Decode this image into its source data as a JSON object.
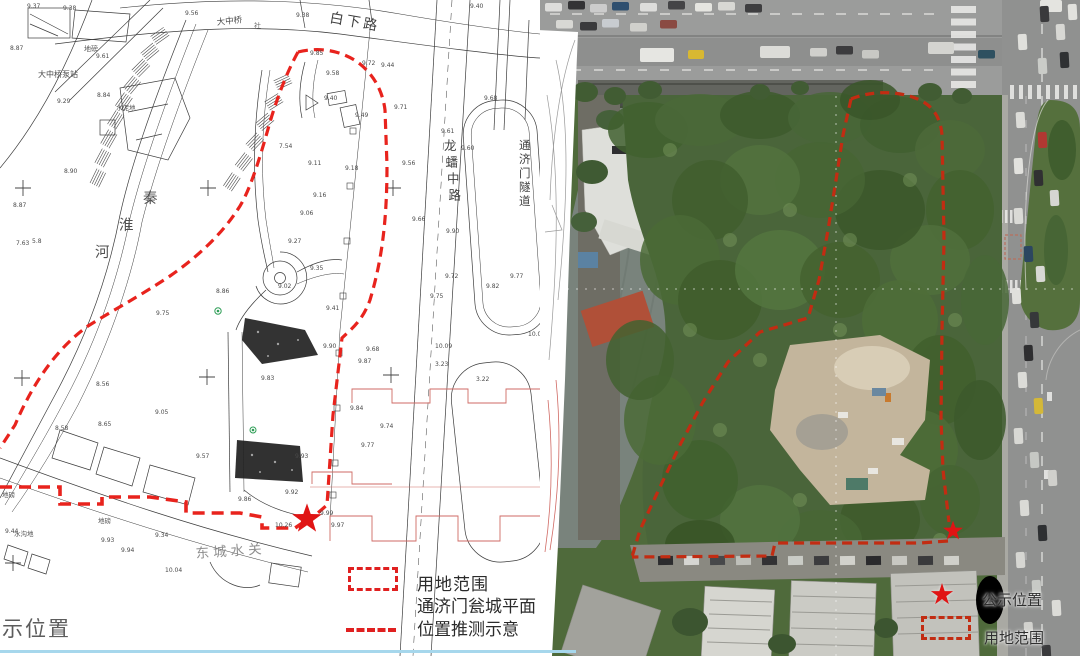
{
  "left_map": {
    "labels": [
      {
        "t": "白下路",
        "x": 329,
        "y": 22,
        "s": 14,
        "r": 10,
        "ls": 3,
        "c": "#3f3f3f"
      },
      {
        "t": "大中桥",
        "x": 217,
        "y": 25,
        "s": 8.5,
        "r": -6,
        "c": "#4a4a4a"
      },
      {
        "t": "社",
        "x": 254,
        "y": 28,
        "s": 7,
        "c": "#6a6a6a"
      },
      {
        "t": "地磅",
        "x": 84,
        "y": 51,
        "s": 7,
        "c": "#555555"
      },
      {
        "t": "大中桥泵站",
        "x": 38,
        "y": 77,
        "s": 8,
        "c": "#4a4a4a"
      },
      {
        "t": "水泥地",
        "x": 116,
        "y": 110,
        "s": 6.5,
        "c": "#555555"
      },
      {
        "t": "秦淮河",
        "x": 143,
        "y": 203,
        "s": 14.5,
        "c": "#4f4f4f",
        "v": {
          "dx": -24,
          "dy": 27
        }
      },
      {
        "t": "龙蟠中路",
        "x": 444,
        "y": 150,
        "s": 12.5,
        "c": "#3f3f3f",
        "v": {
          "dx": 1.5,
          "dy": 16.5
        }
      },
      {
        "t": "通济门隧道",
        "x": 519,
        "y": 149,
        "s": 11.5,
        "c": "#3f3f3f",
        "v": {
          "dx": 0,
          "dy": 14
        }
      },
      {
        "t": "东城水关",
        "x": 196,
        "y": 558,
        "s": 13.5,
        "r": -4,
        "ls": 4,
        "c": "#8f8f8f"
      },
      {
        "t": "地磅",
        "x": 98,
        "y": 523,
        "s": 6.5,
        "c": "#555555"
      },
      {
        "t": "地磅",
        "x": 2,
        "y": 497,
        "s": 6.5,
        "c": "#555555"
      },
      {
        "t": "水沟地",
        "x": 14,
        "y": 536,
        "s": 6.5,
        "c": "#555555"
      }
    ],
    "elevations": [
      [
        27,
        3,
        "9.37"
      ],
      [
        63,
        5,
        "9.38"
      ],
      [
        185,
        10,
        "9.56"
      ],
      [
        296,
        12,
        "9.38"
      ],
      [
        470,
        3,
        "9.40"
      ],
      [
        96,
        53,
        "9.61"
      ],
      [
        10,
        45,
        "8.87"
      ],
      [
        57,
        98,
        "9.29"
      ],
      [
        97,
        92,
        "8.84"
      ],
      [
        13,
        202,
        "8.87"
      ],
      [
        64,
        168,
        "8.90"
      ],
      [
        16,
        240,
        "7.63"
      ],
      [
        32,
        238,
        "5.8"
      ],
      [
        310,
        50,
        "9.85"
      ],
      [
        362,
        60,
        "9.72"
      ],
      [
        381,
        62,
        "9.44"
      ],
      [
        326,
        70,
        "9.58"
      ],
      [
        324,
        95,
        "9.40"
      ],
      [
        355,
        112,
        "9.49"
      ],
      [
        394,
        104,
        "9.71"
      ],
      [
        402,
        160,
        "9.56"
      ],
      [
        484,
        95,
        "9.68"
      ],
      [
        441,
        128,
        "9.61"
      ],
      [
        461,
        145,
        "9.60"
      ],
      [
        279,
        143,
        "7.54"
      ],
      [
        308,
        160,
        "9.11"
      ],
      [
        345,
        165,
        "9.18"
      ],
      [
        313,
        192,
        "9.16"
      ],
      [
        300,
        210,
        "9.06"
      ],
      [
        288,
        238,
        "9.27"
      ],
      [
        310,
        265,
        "9.35"
      ],
      [
        278,
        283,
        "9.02"
      ],
      [
        446,
        228,
        "9.90"
      ],
      [
        412,
        216,
        "9.66"
      ],
      [
        445,
        273,
        "9.72"
      ],
      [
        430,
        293,
        "9.75"
      ],
      [
        510,
        273,
        "9.77"
      ],
      [
        486,
        283,
        "9.82"
      ],
      [
        216,
        288,
        "8.86"
      ],
      [
        156,
        310,
        "9.75"
      ],
      [
        326,
        305,
        "9.41"
      ],
      [
        323,
        343,
        "9.90"
      ],
      [
        366,
        346,
        "9.68"
      ],
      [
        358,
        358,
        "9.87"
      ],
      [
        350,
        405,
        "9.84"
      ],
      [
        380,
        423,
        "9.74"
      ],
      [
        361,
        442,
        "9.77"
      ],
      [
        295,
        453,
        "9.93"
      ],
      [
        285,
        489,
        "9.92"
      ],
      [
        238,
        496,
        "9.86"
      ],
      [
        275,
        522,
        "10.26"
      ],
      [
        331,
        522,
        "9.97"
      ],
      [
        320,
        510,
        "9.99"
      ],
      [
        261,
        375,
        "9.83"
      ],
      [
        155,
        409,
        "9.05"
      ],
      [
        96,
        381,
        "8.56"
      ],
      [
        55,
        425,
        "8.58"
      ],
      [
        98,
        421,
        "8.65"
      ],
      [
        196,
        453,
        "9.57"
      ],
      [
        435,
        343,
        "10.09"
      ],
      [
        528,
        331,
        "10.01"
      ],
      [
        435,
        361,
        "3.23"
      ],
      [
        476,
        376,
        "3.22"
      ],
      [
        5,
        528,
        "9.44"
      ],
      [
        101,
        537,
        "9.93"
      ],
      [
        155,
        532,
        "9.34"
      ],
      [
        165,
        567,
        "10.04"
      ],
      [
        121,
        547,
        "9.94"
      ]
    ],
    "legend": {
      "rect_label": "用地范围",
      "line_label_1": "通济门瓮城平面",
      "line_label_2": "位置推测示意"
    },
    "corner_text": "示位置"
  },
  "right_photo": {
    "legend": {
      "star_label": "公示位置",
      "rect_label": "用地范围"
    }
  },
  "colors": {
    "boundary_red": "#e8231d",
    "photo_boundary_red": "#c22c12",
    "legend_red": "#e02020",
    "star_red": "#e01414",
    "bottom_strip_blue": "#a6d7ec"
  }
}
